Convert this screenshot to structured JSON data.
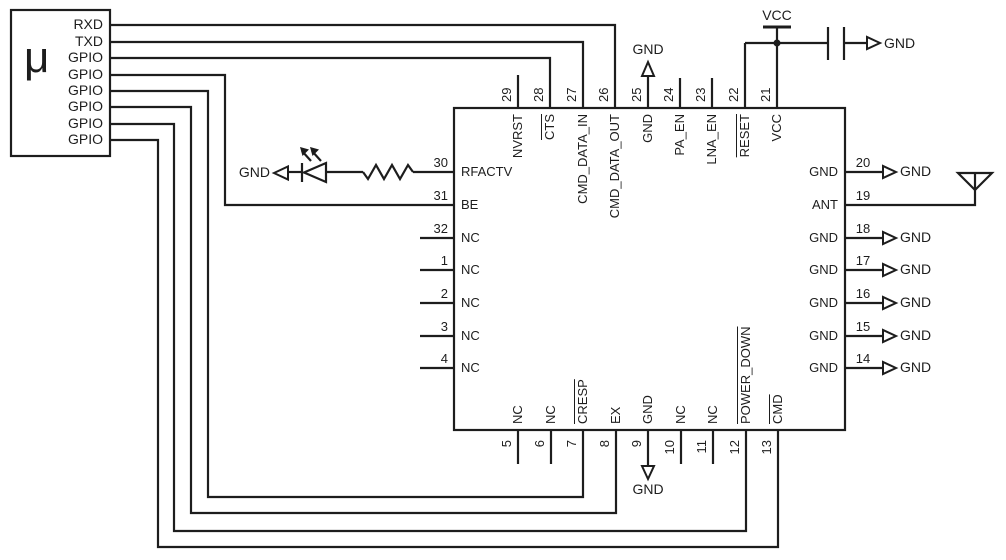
{
  "colors": {
    "background": "#ffffff",
    "line": "#1d1d1d"
  },
  "micro": {
    "label": "μ",
    "pins": [
      "RXD",
      "TXD",
      "GPIO",
      "GPIO",
      "GPIO",
      "GPIO",
      "GPIO",
      "GPIO"
    ]
  },
  "ic": {
    "top_pins": [
      {
        "number": "29",
        "label": "NVRST",
        "overline": false
      },
      {
        "number": "28",
        "label": "CTS",
        "overline": true
      },
      {
        "number": "27",
        "label": "CMD_DATA_IN",
        "overline": false
      },
      {
        "number": "26",
        "label": "CMD_DATA_OUT",
        "overline": false
      },
      {
        "number": "25",
        "label": "GND",
        "overline": false
      },
      {
        "number": "24",
        "label": "PA_EN",
        "overline": false
      },
      {
        "number": "23",
        "label": "LNA_EN",
        "overline": false
      },
      {
        "number": "22",
        "label": "RESET",
        "overline": true
      },
      {
        "number": "21",
        "label": "VCC",
        "overline": false
      }
    ],
    "left_pins": [
      {
        "number": "30",
        "label": "RFACTV"
      },
      {
        "number": "31",
        "label": "BE"
      },
      {
        "number": "32",
        "label": "NC"
      },
      {
        "number": "1",
        "label": "NC"
      },
      {
        "number": "2",
        "label": "NC"
      },
      {
        "number": "3",
        "label": "NC"
      },
      {
        "number": "4",
        "label": "NC"
      }
    ],
    "bottom_pins": [
      {
        "number": "5",
        "label": "NC",
        "overline": false
      },
      {
        "number": "6",
        "label": "NC",
        "overline": false
      },
      {
        "number": "7",
        "label": "CRESP",
        "overline": true
      },
      {
        "number": "8",
        "label": "EX",
        "overline": false
      },
      {
        "number": "9",
        "label": "GND",
        "overline": false
      },
      {
        "number": "10",
        "label": "NC",
        "overline": false
      },
      {
        "number": "11",
        "label": "NC",
        "overline": false
      },
      {
        "number": "12",
        "label": "POWER_DOWN",
        "overline": true
      },
      {
        "number": "13",
        "label": "CMD",
        "overline": true
      }
    ],
    "right_pins": [
      {
        "number": "20",
        "label": "GND"
      },
      {
        "number": "19",
        "label": "ANT"
      },
      {
        "number": "18",
        "label": "GND"
      },
      {
        "number": "17",
        "label": "GND"
      },
      {
        "number": "16",
        "label": "GND"
      },
      {
        "number": "15",
        "label": "GND"
      },
      {
        "number": "14",
        "label": "GND"
      }
    ]
  },
  "nets": {
    "vcc_label": "VCC",
    "gnd_label": "GND"
  },
  "icons": {
    "led": "led-icon",
    "resistor": "resistor-icon",
    "capacitor": "capacitor-icon",
    "antenna": "antenna-icon",
    "vcc_power": "vcc-power-symbol",
    "ground_arrow": "ground-arrow-icon"
  }
}
